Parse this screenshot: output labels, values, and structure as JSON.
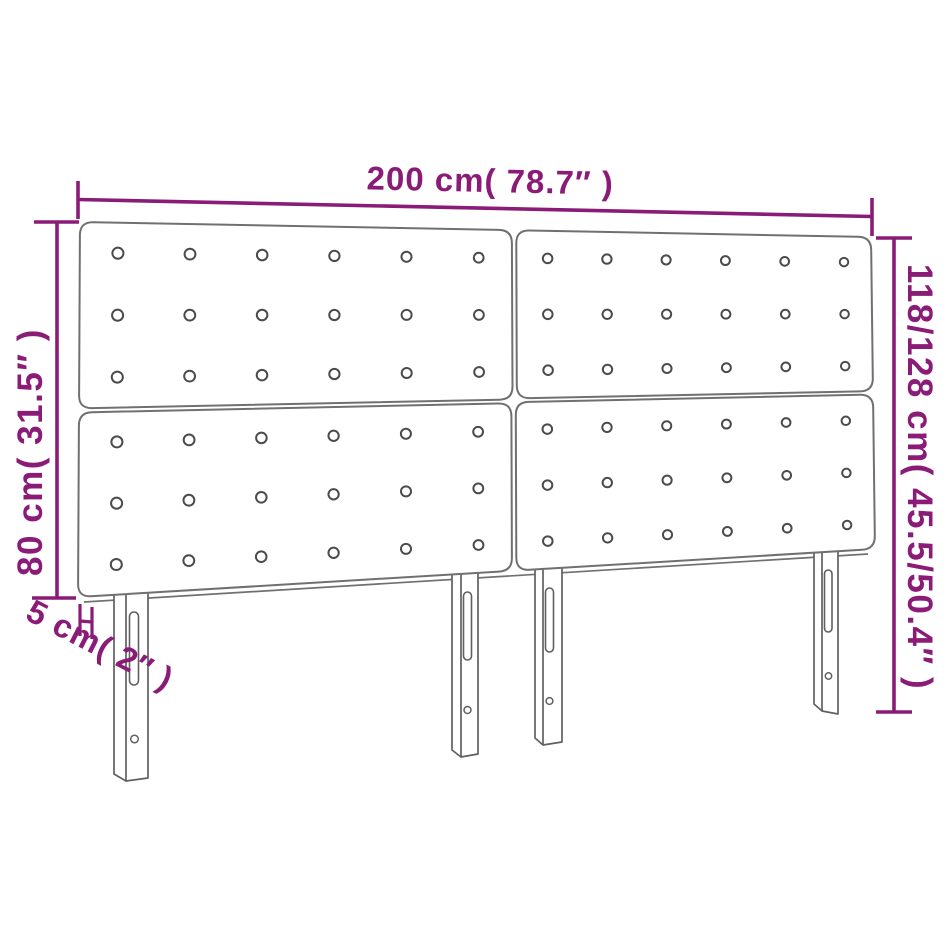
{
  "page": {
    "background": "#ffffff",
    "description": "Dimension diagram of an upholstered headboard made of four tufted panels with four slotted mounting legs"
  },
  "colors": {
    "dimension": "#8a1c78",
    "panel_outline": "#707070",
    "button_outline": "#4b4b4b",
    "leg_outline": "#606060",
    "surface": "#ffffff"
  },
  "dimensions": {
    "width": {
      "label": "200 cm( 78.7″ )"
    },
    "height_left": {
      "label": "80 cm( 31.5″ )"
    },
    "height_right": {
      "label": "118/128 cm( 45.5/50.4″ )"
    },
    "depth": {
      "label": "5 cm( 2″ )"
    }
  },
  "structure": {
    "panel_rows": 2,
    "panel_cols": 2,
    "button_rows_per_panel": 3,
    "button_cols_per_panel": 6,
    "leg_count": 4
  }
}
